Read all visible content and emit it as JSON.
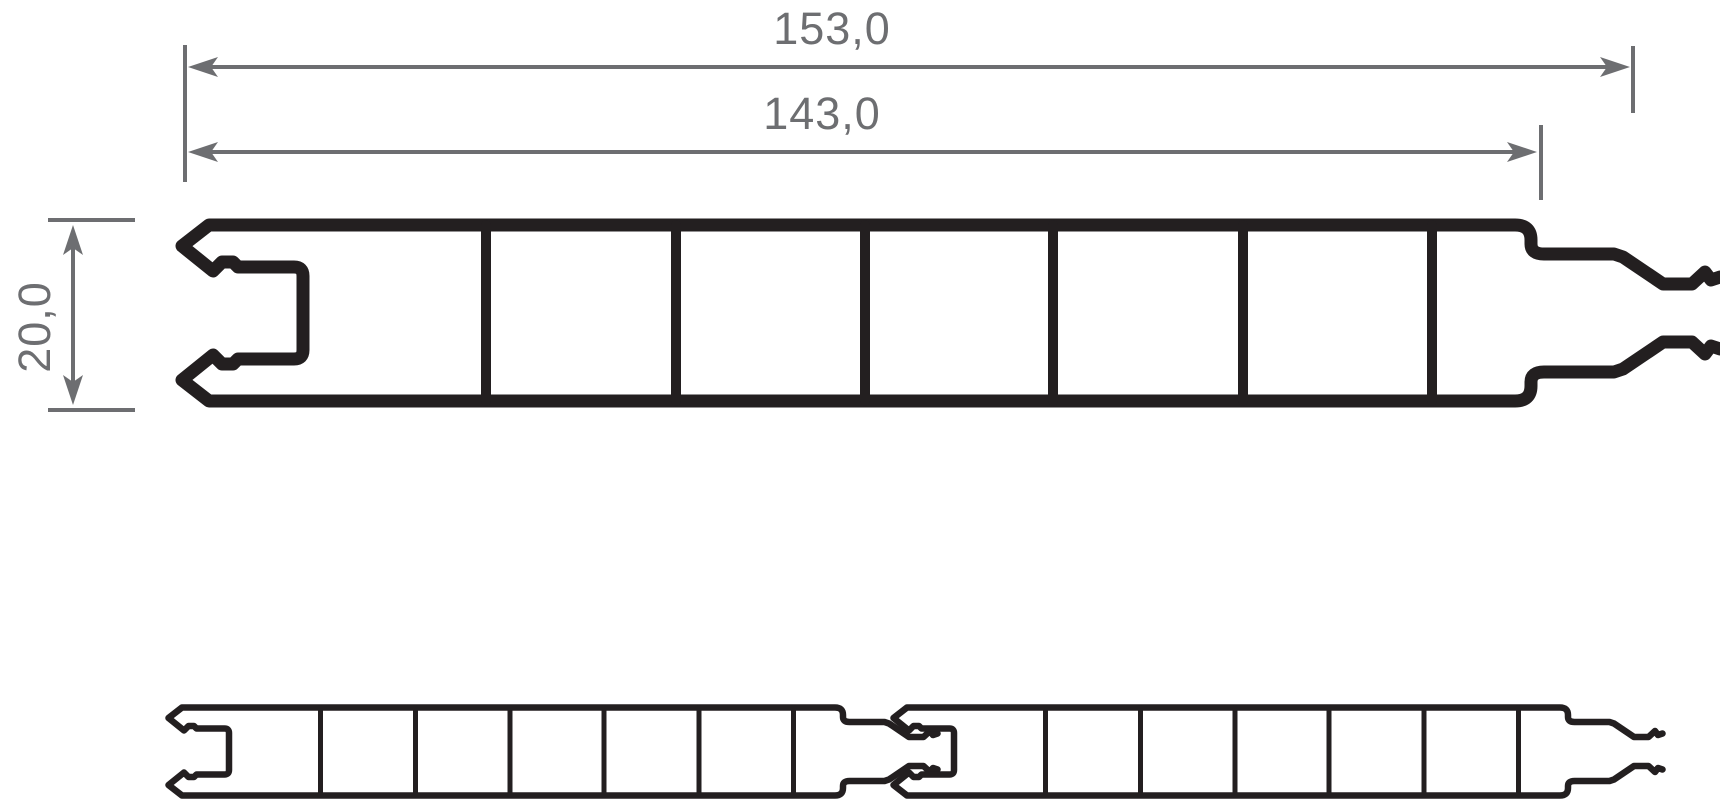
{
  "drawing": {
    "type": "technical-cross-section",
    "subject": "hollow chamber panel profile with tongue-and-groove lock",
    "views": [
      {
        "name": "single-profile-section",
        "position": "top"
      },
      {
        "name": "two-profiles-interlocked",
        "position": "bottom"
      }
    ],
    "chambers_per_profile": 7,
    "web_count": 6
  },
  "dimensions": [
    {
      "name": "total-width",
      "label": "153,0",
      "orientation": "horizontal"
    },
    {
      "name": "visible-width",
      "label": "143,0",
      "orientation": "horizontal"
    },
    {
      "name": "profile-height",
      "label": "20,0",
      "orientation": "vertical"
    }
  ],
  "colors": {
    "profile_outline": "#231f20",
    "dimension_lines": "#6d6e71",
    "dimension_text": "#6d6e71",
    "background": "#ffffff"
  }
}
